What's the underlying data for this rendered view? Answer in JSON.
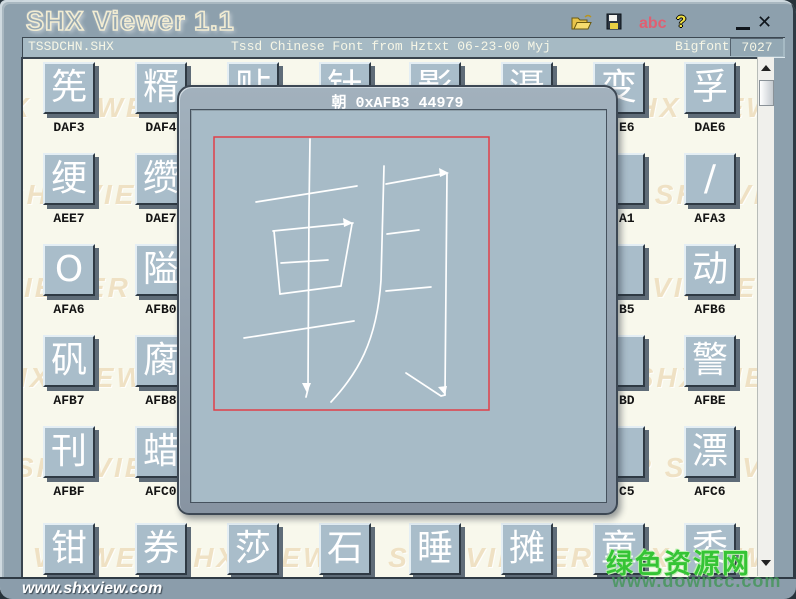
{
  "window": {
    "title": "SHX Viewer 1.1",
    "minimize_glyph": "",
    "close_glyph": "✕"
  },
  "toolbar": {
    "abc_label": "abc",
    "help_label": "?"
  },
  "status_bar": {
    "file": "TSSDCHN.SHX",
    "description": "Tssd Chinese Font from Hztxt 06-23-00 Myj",
    "font_type": "Bigfont",
    "glyph_count": "7027"
  },
  "preview": {
    "char": "朝",
    "code_hex": "0xAFB3",
    "code_dec": "44979",
    "title": "朝 0xAFB3 44979"
  },
  "watermark": {
    "text": "SHX VIEWER"
  },
  "footer": {
    "url": "www.shxview.com"
  },
  "site_watermark": {
    "name": "绿色资源网",
    "url": "www.downcc.com"
  },
  "colors": {
    "frame": "#8da0ad",
    "canvas": "#f8f8ec",
    "cell_face": "#a9bdca",
    "watermark": "#efe1c4",
    "popup_body": "#a7bbc7",
    "preview_box": "#e04048",
    "stroke": "#ffffff",
    "green_watermark": "#35c435"
  },
  "grid": {
    "rows": [
      [
        {
          "char": "筅",
          "label": "DAF3"
        },
        {
          "char": "糈",
          "label": "DAF4"
        },
        {
          "char": "贴",
          "label": ""
        },
        {
          "char": "钍",
          "label": ""
        },
        {
          "char": "影",
          "label": ""
        },
        {
          "char": "滠",
          "label": ""
        },
        {
          "char": "变",
          "label": "E6",
          "fragment": true
        },
        {
          "char": "孚",
          "label": "DAE6"
        }
      ],
      [
        {
          "char": "绠",
          "label": "AEE7"
        },
        {
          "char": "缵",
          "label": "DAE7"
        },
        {},
        {},
        {},
        {},
        {
          "char": "",
          "label": "A1",
          "fragment": true
        },
        {
          "char": "/",
          "label": "AFA3"
        }
      ],
      [
        {
          "char": "O",
          "label": "AFA6"
        },
        {
          "char": "隘",
          "label": "AFB0"
        },
        {},
        {},
        {},
        {},
        {
          "char": "",
          "label": "B5",
          "fragment": true
        },
        {
          "char": "动",
          "label": "AFB6"
        }
      ],
      [
        {
          "char": "矾",
          "label": "AFB7"
        },
        {
          "char": "腐",
          "label": "AFB8"
        },
        {},
        {},
        {},
        {},
        {
          "char": "",
          "label": "BD",
          "fragment": true
        },
        {
          "char": "警",
          "label": "AFBE"
        }
      ],
      [
        {
          "char": "刊",
          "label": "AFBF"
        },
        {
          "char": "蜡",
          "label": "AFC0"
        },
        {},
        {},
        {},
        {},
        {
          "char": "",
          "label": "C5",
          "fragment": true
        },
        {
          "char": "漂",
          "label": "AFC6"
        }
      ],
      [
        {
          "char": "钳",
          "label": ""
        },
        {
          "char": "券",
          "label": ""
        },
        {
          "char": "莎",
          "label": ""
        },
        {
          "char": "石",
          "label": ""
        },
        {
          "char": "睡",
          "label": ""
        },
        {
          "char": "摊",
          "label": ""
        },
        {
          "char": "童",
          "label": ""
        },
        {
          "char": "委",
          "label": ""
        }
      ]
    ]
  }
}
